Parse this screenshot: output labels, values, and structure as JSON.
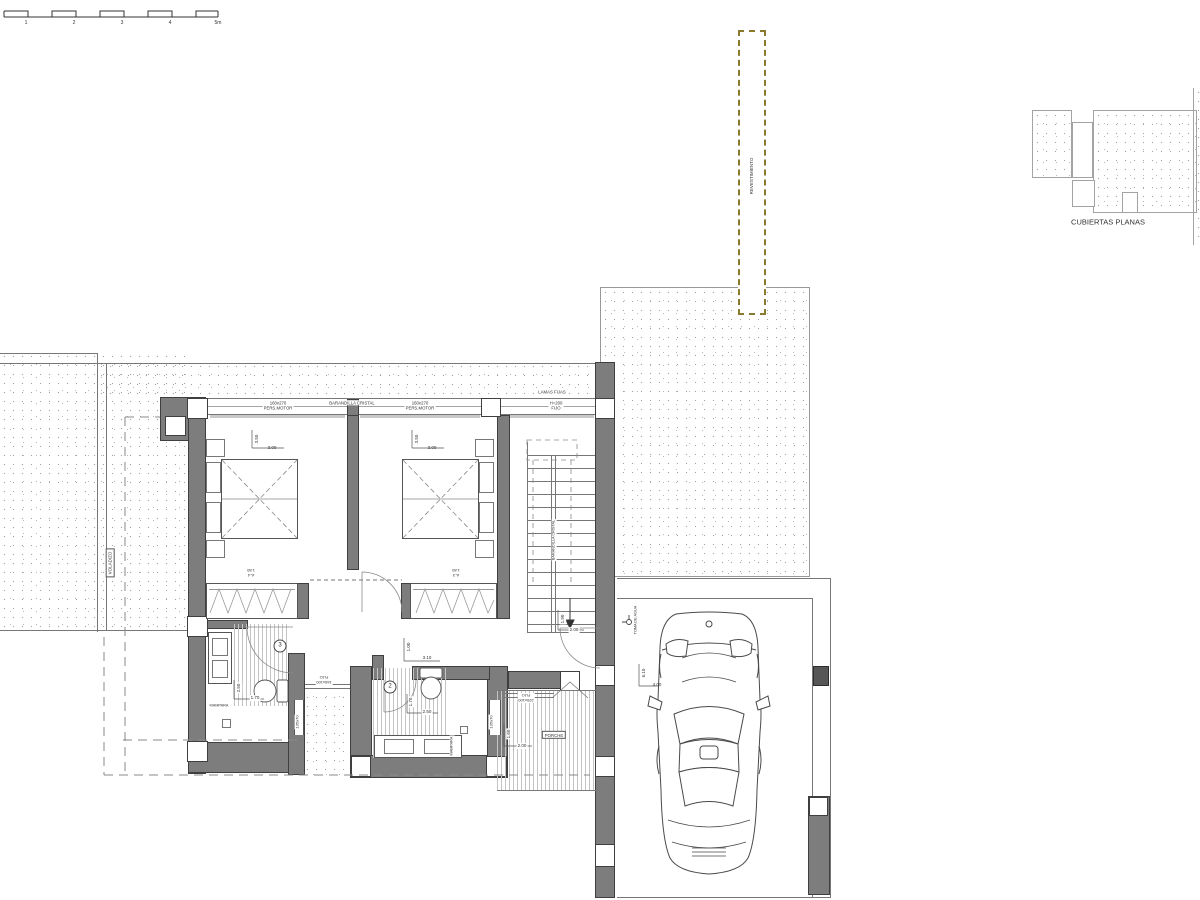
{
  "plan": {
    "kind": "architectural-floor-plan"
  },
  "colors": {
    "wall_fill": "#7d7d7d",
    "wall_edge": "#3f3f3f",
    "line": "#777777",
    "stipple": "#a3a3a3",
    "revestimiento_dash": "#8a7a2e",
    "text": "#333333"
  },
  "labels": [
    {
      "name": "scale-tick-1",
      "text": "1",
      "x": 26,
      "y": 23,
      "size": 5
    },
    {
      "name": "scale-tick-2",
      "text": "2",
      "x": 74,
      "y": 23,
      "size": 5
    },
    {
      "name": "scale-tick-3",
      "text": "3",
      "x": 122,
      "y": 23,
      "size": 5
    },
    {
      "name": "scale-tick-4",
      "text": "4",
      "x": 170,
      "y": 23,
      "size": 5
    },
    {
      "name": "scale-tick-5m",
      "text": "5m",
      "x": 218,
      "y": 23,
      "size": 5
    },
    {
      "name": "revestimiento-label",
      "text": "REVESTIMIENTO",
      "x": 752,
      "y": 176,
      "rot": -90,
      "size": 4.5
    },
    {
      "name": "cubiertas-planas-label",
      "text": "CUBIERTAS PLANAS",
      "x": 1108,
      "y": 222,
      "size": 7.5
    },
    {
      "name": "window-label-pers-motor-1",
      "text": "160x270\nPERS.MOTOR",
      "x": 278,
      "y": 406,
      "size": 4.3,
      "bg": true
    },
    {
      "name": "window-label-barandilla-cristal",
      "text": "BARANDILLA CRISTAL",
      "x": 352,
      "y": 403,
      "size": 4.3,
      "bg": true
    },
    {
      "name": "window-label-pers-motor-2",
      "text": "160x270\nPERS.MOTOR",
      "x": 420,
      "y": 406,
      "size": 4.3,
      "bg": true
    },
    {
      "name": "window-label-lamas-fijas",
      "text": "LAMAS FIJAS",
      "x": 552,
      "y": 392,
      "size": 4.3,
      "bg": true
    },
    {
      "name": "window-label-fijo-h200",
      "text": "H=200\nFIJO",
      "x": 556,
      "y": 406,
      "size": 4.3,
      "bg": true
    },
    {
      "name": "dim-bed1-depth",
      "text": "3.50",
      "x": 257,
      "y": 439,
      "rot": -90,
      "size": 4.5
    },
    {
      "name": "dim-bed1-width",
      "text": "3.00",
      "x": 272,
      "y": 448,
      "size": 4.5
    },
    {
      "name": "dim-bed2-depth",
      "text": "3.50",
      "x": 417,
      "y": 439,
      "rot": -90,
      "size": 4.5
    },
    {
      "name": "dim-bed2-width",
      "text": "3.00",
      "x": 432,
      "y": 448,
      "size": 4.5
    },
    {
      "name": "closet1-label",
      "text": "A-4\n1.80",
      "x": 251,
      "y": 573,
      "rot": 180,
      "size": 4
    },
    {
      "name": "closet2-label",
      "text": "A-3\n1.80",
      "x": 456,
      "y": 573,
      "rot": 180,
      "size": 4
    },
    {
      "name": "room3-number",
      "text": "3",
      "x": 280,
      "y": 646,
      "size": 6,
      "circle": true
    },
    {
      "name": "room2-number",
      "text": "2",
      "x": 390,
      "y": 687,
      "size": 6,
      "circle": true
    },
    {
      "name": "dim-bath3-250",
      "text": "2.50",
      "x": 239,
      "y": 688,
      "rot": -90,
      "size": 4.5,
      "bg": true
    },
    {
      "name": "dim-bath3-170",
      "text": "1.70",
      "x": 255,
      "y": 698,
      "size": 4.5,
      "bg": true
    },
    {
      "name": "mampara-bath3-label",
      "text": "MAMPARA",
      "x": 219,
      "y": 706,
      "size": 3.8,
      "bg": true
    },
    {
      "name": "dim-hall-100",
      "text": "1.00",
      "x": 409,
      "y": 647,
      "rot": -90,
      "size": 4.5
    },
    {
      "name": "dim-hall-310",
      "text": "3.10",
      "x": 427,
      "y": 658,
      "size": 4.5
    },
    {
      "name": "dim-bath2-170",
      "text": "1.70",
      "x": 411,
      "y": 702,
      "rot": -90,
      "size": 4.5,
      "bg": true
    },
    {
      "name": "dim-bath2-250",
      "text": "2.50",
      "x": 427,
      "y": 712,
      "size": 4.5,
      "bg": true
    },
    {
      "name": "mampara-bath2-label",
      "text": "MAMPARA",
      "x": 452,
      "y": 746,
      "rot": -90,
      "size": 3.8,
      "bg": true
    },
    {
      "name": "window-bath3-size",
      "text": "135x70",
      "x": 297,
      "y": 722,
      "rot": -90,
      "size": 4,
      "bg": true
    },
    {
      "name": "window-bath2-size",
      "text": "135x70",
      "x": 491,
      "y": 722,
      "rot": -90,
      "size": 4,
      "bg": true
    },
    {
      "name": "patio-window-label",
      "text": "165x100\nFIJO",
      "x": 324,
      "y": 680,
      "rot": 180,
      "size": 4,
      "bg": true
    },
    {
      "name": "porch-window-label",
      "text": "220x100\nFIJO",
      "x": 526,
      "y": 698,
      "rot": 180,
      "size": 4,
      "bg": true
    },
    {
      "name": "voladizo-label",
      "text": "VOLADIZO",
      "x": 110,
      "y": 563,
      "rot": -90,
      "size": 4.5,
      "box": true
    },
    {
      "name": "stair-barandilla-label",
      "text": "BARANDILLA CRISTAL",
      "x": 554,
      "y": 540,
      "rot": -90,
      "size": 3.8,
      "bg": true
    },
    {
      "name": "dim-stair-190",
      "text": "1.90",
      "x": 563,
      "y": 619,
      "rot": -90,
      "size": 4.5,
      "bg": true
    },
    {
      "name": "dim-stair-200",
      "text": "2.00",
      "x": 574,
      "y": 630,
      "size": 4.5,
      "bg": true
    },
    {
      "name": "porche-label",
      "text": "PORCHE",
      "x": 554,
      "y": 735,
      "size": 4.3,
      "box": true
    },
    {
      "name": "dim-porch-160",
      "text": "1.60",
      "x": 509,
      "y": 734,
      "rot": -90,
      "size": 4.5,
      "bg": true
    },
    {
      "name": "dim-porch-200",
      "text": "2.00",
      "x": 522,
      "y": 746,
      "size": 4.5,
      "bg": true
    },
    {
      "name": "toma-de-agua-label",
      "text": "TOMA DE AGUA",
      "x": 636,
      "y": 620,
      "rot": -90,
      "size": 3.8
    },
    {
      "name": "dim-garage-length",
      "text": "6.10",
      "x": 644,
      "y": 673,
      "rot": -90,
      "size": 4.5
    },
    {
      "name": "dim-garage-width",
      "text": "4.00",
      "x": 657,
      "y": 685,
      "size": 4.5
    }
  ]
}
